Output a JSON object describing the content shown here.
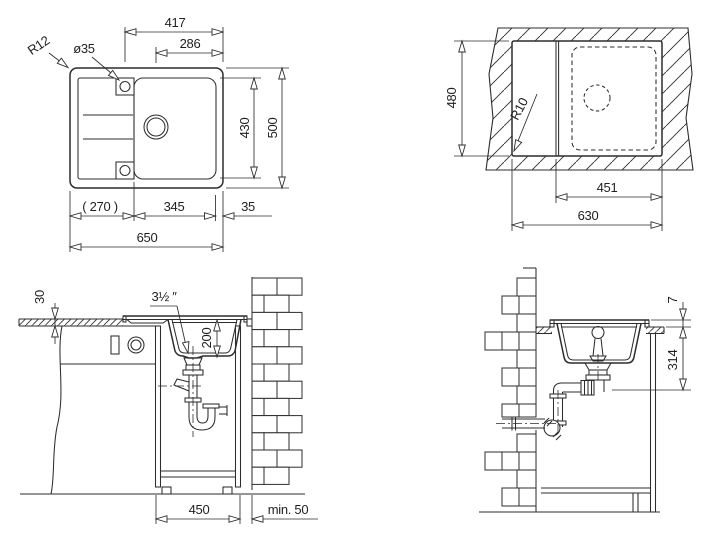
{
  "drawing": {
    "title": "sink installation technical drawing",
    "ink_color": "#2d2d2d",
    "background": "#ffffff",
    "top_view": {
      "label_corner_radius": "R12",
      "label_tap_hole": "ø35",
      "dim_width_to_hole": "417",
      "dim_width_to_drain": "286",
      "dim_inner_height": "430",
      "dim_overall_height": "500",
      "dim_drainboard": "( 270 )",
      "dim_bowl": "345",
      "dim_edge": "35",
      "dim_overall_width": "650"
    },
    "cutout_view": {
      "label_cutout_radius": "R10",
      "dim_cutout_height": "480",
      "dim_bowl_cutout": "451",
      "dim_cutout_width": "630"
    },
    "front_section": {
      "dim_worktop_thickness": "30",
      "label_drain_size": "3½ ″",
      "dim_bowl_depth": "200",
      "dim_cabinet_width": "450",
      "dim_wall_gap": "min. 50"
    },
    "side_section": {
      "dim_rim_height": "7",
      "dim_depth_to_outlet": "314"
    }
  }
}
